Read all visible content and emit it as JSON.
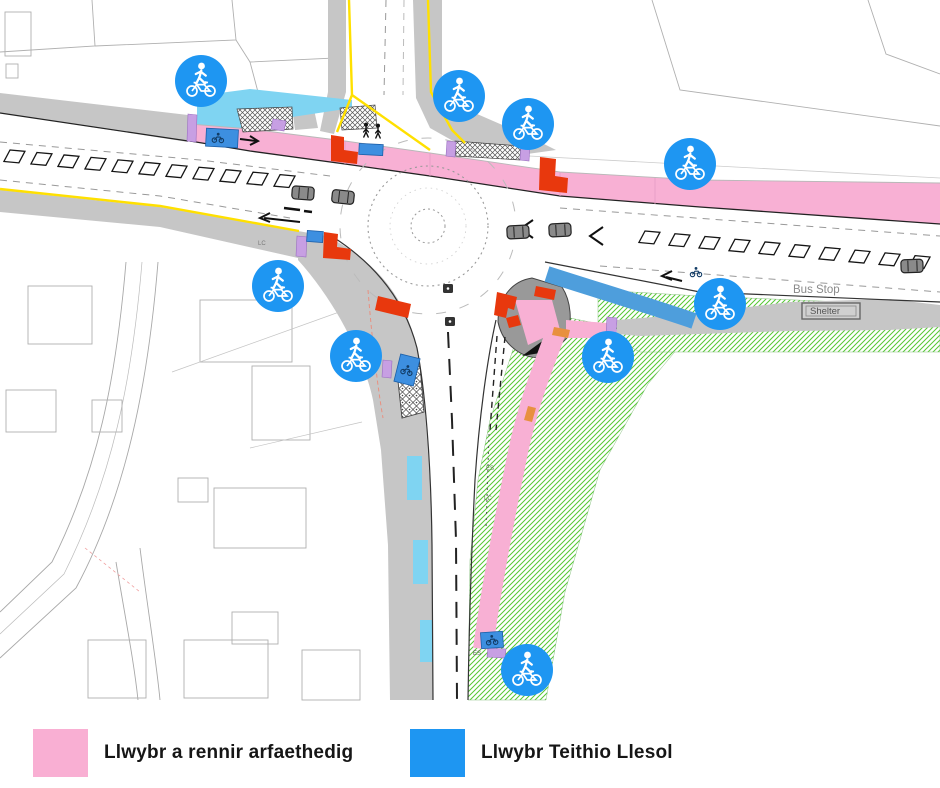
{
  "legend": {
    "items": [
      {
        "id": "shared-path",
        "label": "Llwybr a rennir arfaethedig",
        "color": "#F9AFD3"
      },
      {
        "id": "active-travel",
        "label": "Llwybr Teithio Llesol",
        "color": "#1E96F2"
      }
    ]
  },
  "map": {
    "type": "junction-improvement-plan",
    "labels": {
      "bus_stop": "Bus Stop",
      "shelter": "Shelter",
      "lc": "LC",
      "es": "ES"
    },
    "icons": {
      "symbol": "shared-use-path-sign-pedestrian-over-bicycle",
      "color": "#1E96F2",
      "count": 9,
      "positions": [
        [
          201,
          81
        ],
        [
          459,
          96
        ],
        [
          528,
          124
        ],
        [
          690,
          164
        ],
        [
          278,
          286
        ],
        [
          356,
          356
        ],
        [
          720,
          304
        ],
        [
          608,
          357
        ],
        [
          527,
          670
        ]
      ]
    },
    "colors": {
      "shared_path_pink": "#F8B0D4",
      "active_travel_blue": "#4E9EDC",
      "light_cycle_cyan": "#7FD4F2",
      "tactile_red": "#E8380D",
      "tactile_purple": "#C79FE3",
      "verge_green": "#55C833",
      "footway_grey": "#C6C6C6",
      "edge_line_yellow": "#FFE000"
    }
  }
}
